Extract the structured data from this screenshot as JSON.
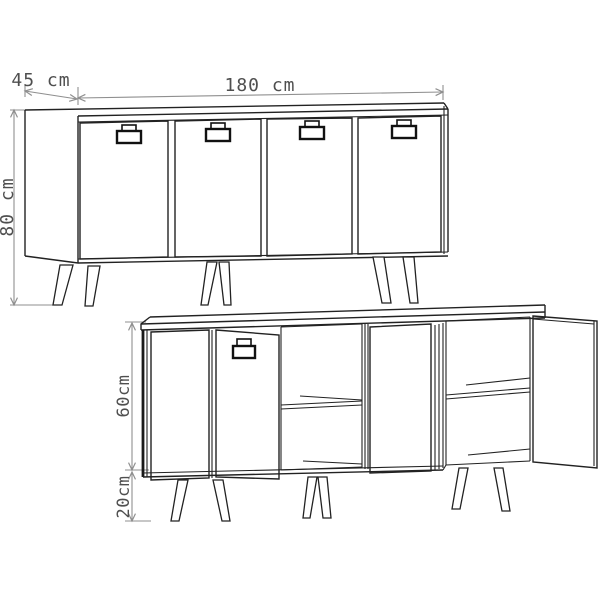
{
  "colors": {
    "background": "#ffffff",
    "cabinet_line": "#222222",
    "dimension_line": "#8f8f8f",
    "dimension_text": "#4f4f4f"
  },
  "front_view": {
    "depth_label": "45 cm",
    "width_label": "180 cm",
    "height_label": "80 cm"
  },
  "open_view": {
    "body_height_label": "60cm",
    "leg_height_label": "20cm"
  }
}
